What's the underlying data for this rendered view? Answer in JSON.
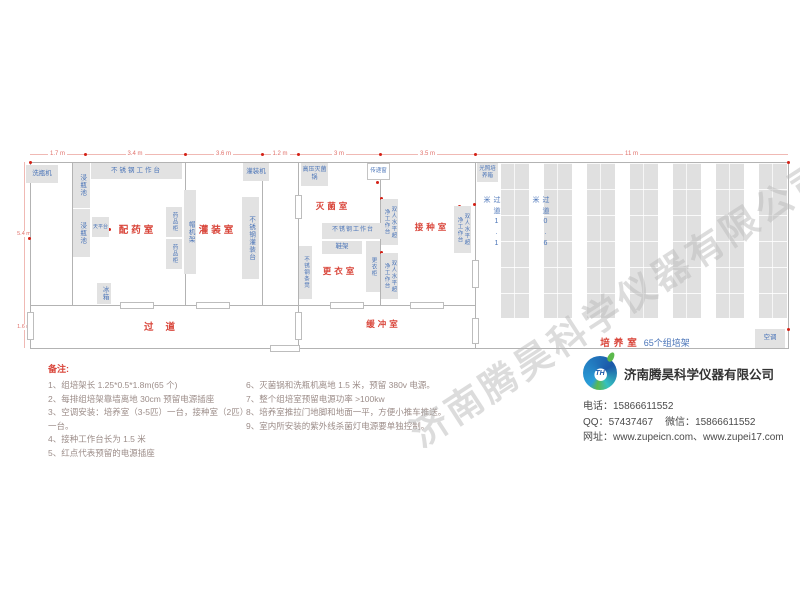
{
  "watermark": "济南腾昊科学仪器有限公司",
  "dims": {
    "top": [
      "1.7 m",
      "3.4 m",
      "3.6 m",
      "1.2 m",
      "3 m",
      "3.5 m",
      "11 m"
    ],
    "left": [
      "5.4 m",
      "1.6 m"
    ]
  },
  "rooms": {
    "prep": "配药室",
    "fill": "灌装室",
    "steril": "灭菌室",
    "dress": "更衣室",
    "inocul": "接种室",
    "corridor": "过道",
    "buffer": "缓冲室",
    "culture_red": "培养室",
    "culture_blue": "65个组培架"
  },
  "equipment": {
    "washer": "洗瓶机",
    "soak": "浸瓶池",
    "bench_top": "不锈钢工作台",
    "filler": "灌装机",
    "balance": "天平台",
    "med_cabinet": "药品柜",
    "cap_rack": "帽机架",
    "fill_bench": "不锈钢灌装台",
    "fridge": "冰箱",
    "autoclave": "高压灭菌锅",
    "pass_window": "传递窗",
    "bench_mid": "不锈钢工作台",
    "shoe_rack": "鞋架",
    "locker": "更衣柜",
    "bench_seat": "不锈钢条凳",
    "clean_bench": "双人水平超净工作台",
    "light_incubator": "光照培养箱",
    "ac": "空调"
  },
  "aisles": {
    "a11": "过道1.1米",
    "a06": "过道0.6米"
  },
  "notes": {
    "heading": "备注:",
    "col1": [
      "1、组培架长 1.25*0.5*1.8m(65 个)",
      "2、每排组培架靠墙离地 30cm 预留电源插座",
      "3、空调安装：培养室（3-5匹）一台，接种室（2匹）一台。",
      "4、接种工作台长为 1.5 米",
      "5、红点代表预留的电源插座"
    ],
    "col2": [
      "6、灭菌锅和洗瓶机离地 1.5 米，预留 380v 电源。",
      "7、整个组培室预留电源功率 >100kw",
      "8、培养室推拉门地脚和地面一平，方便小推车推送。",
      "9、室内所安装的紫外线杀菌灯电源要单独控制。"
    ]
  },
  "company": {
    "logo_text": "TH",
    "name": "济南腾昊科学仪器有限公司",
    "phone_label": "电话：",
    "phone": "15866611552",
    "qq_label": "QQ：",
    "qq": "57437467",
    "wechat_label": "微信：",
    "wechat": "15866611552",
    "web_label": "网址：",
    "web1": "www.zupeicn.com",
    "web_sep": "、",
    "web2": "www.zupei17.com"
  },
  "colors": {
    "room_label": "#d9453a",
    "equipment_label": "#4a74b8",
    "dimension": "#e0706a",
    "box_fill": "#e2e2e2",
    "wall": "#b3b3b3",
    "outlet_dot": "#d42015",
    "watermark": "#b9b9b9",
    "logo_blue": "#1b58a8",
    "logo_green": "#5cb94c"
  }
}
